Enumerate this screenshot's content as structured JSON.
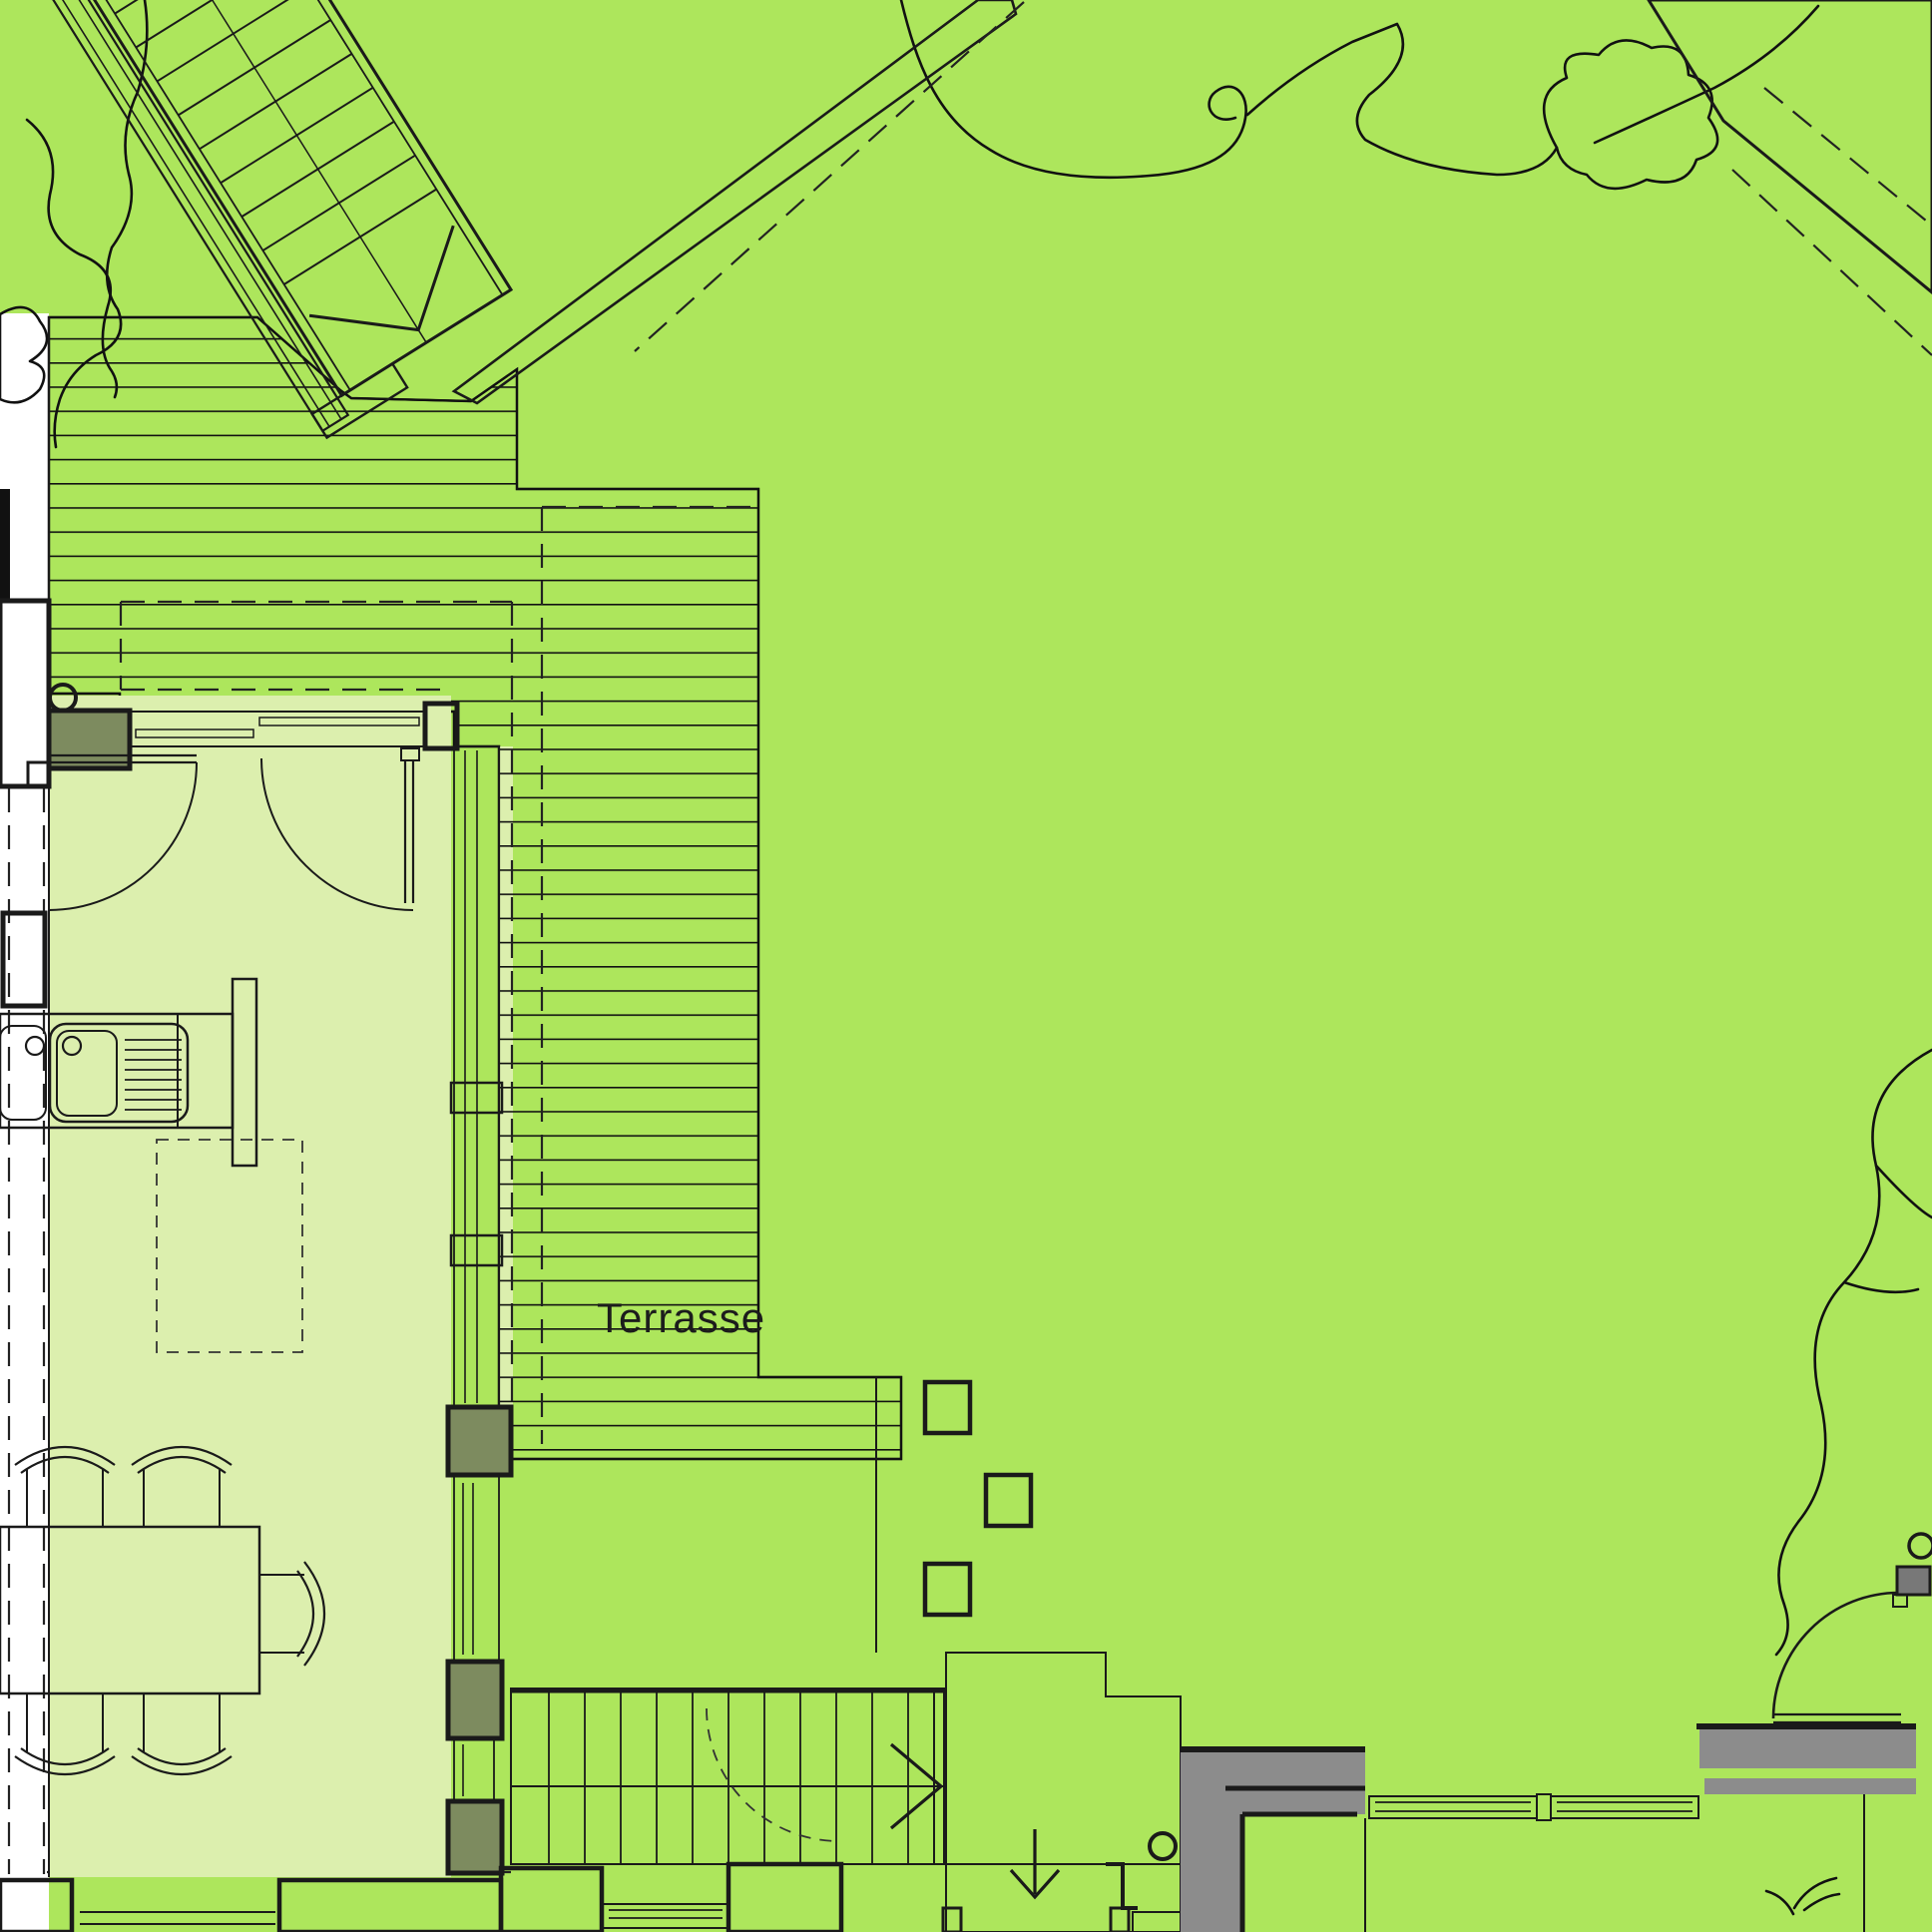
{
  "labels": {
    "terrace": "Terrasse"
  },
  "colors": {
    "lawn": "#ade65c",
    "interior_room": "#dcefae",
    "wall_gray": "#8c8c8c",
    "post_olive": "#7d8b5f",
    "door_gray": "#787878",
    "line": "#1a1a1a",
    "paper": "#ffffff"
  },
  "features": {
    "stepping_stone_count": 3,
    "dining_chair_count": 5,
    "interior_door_count": 2,
    "garden_door_count": 1
  }
}
